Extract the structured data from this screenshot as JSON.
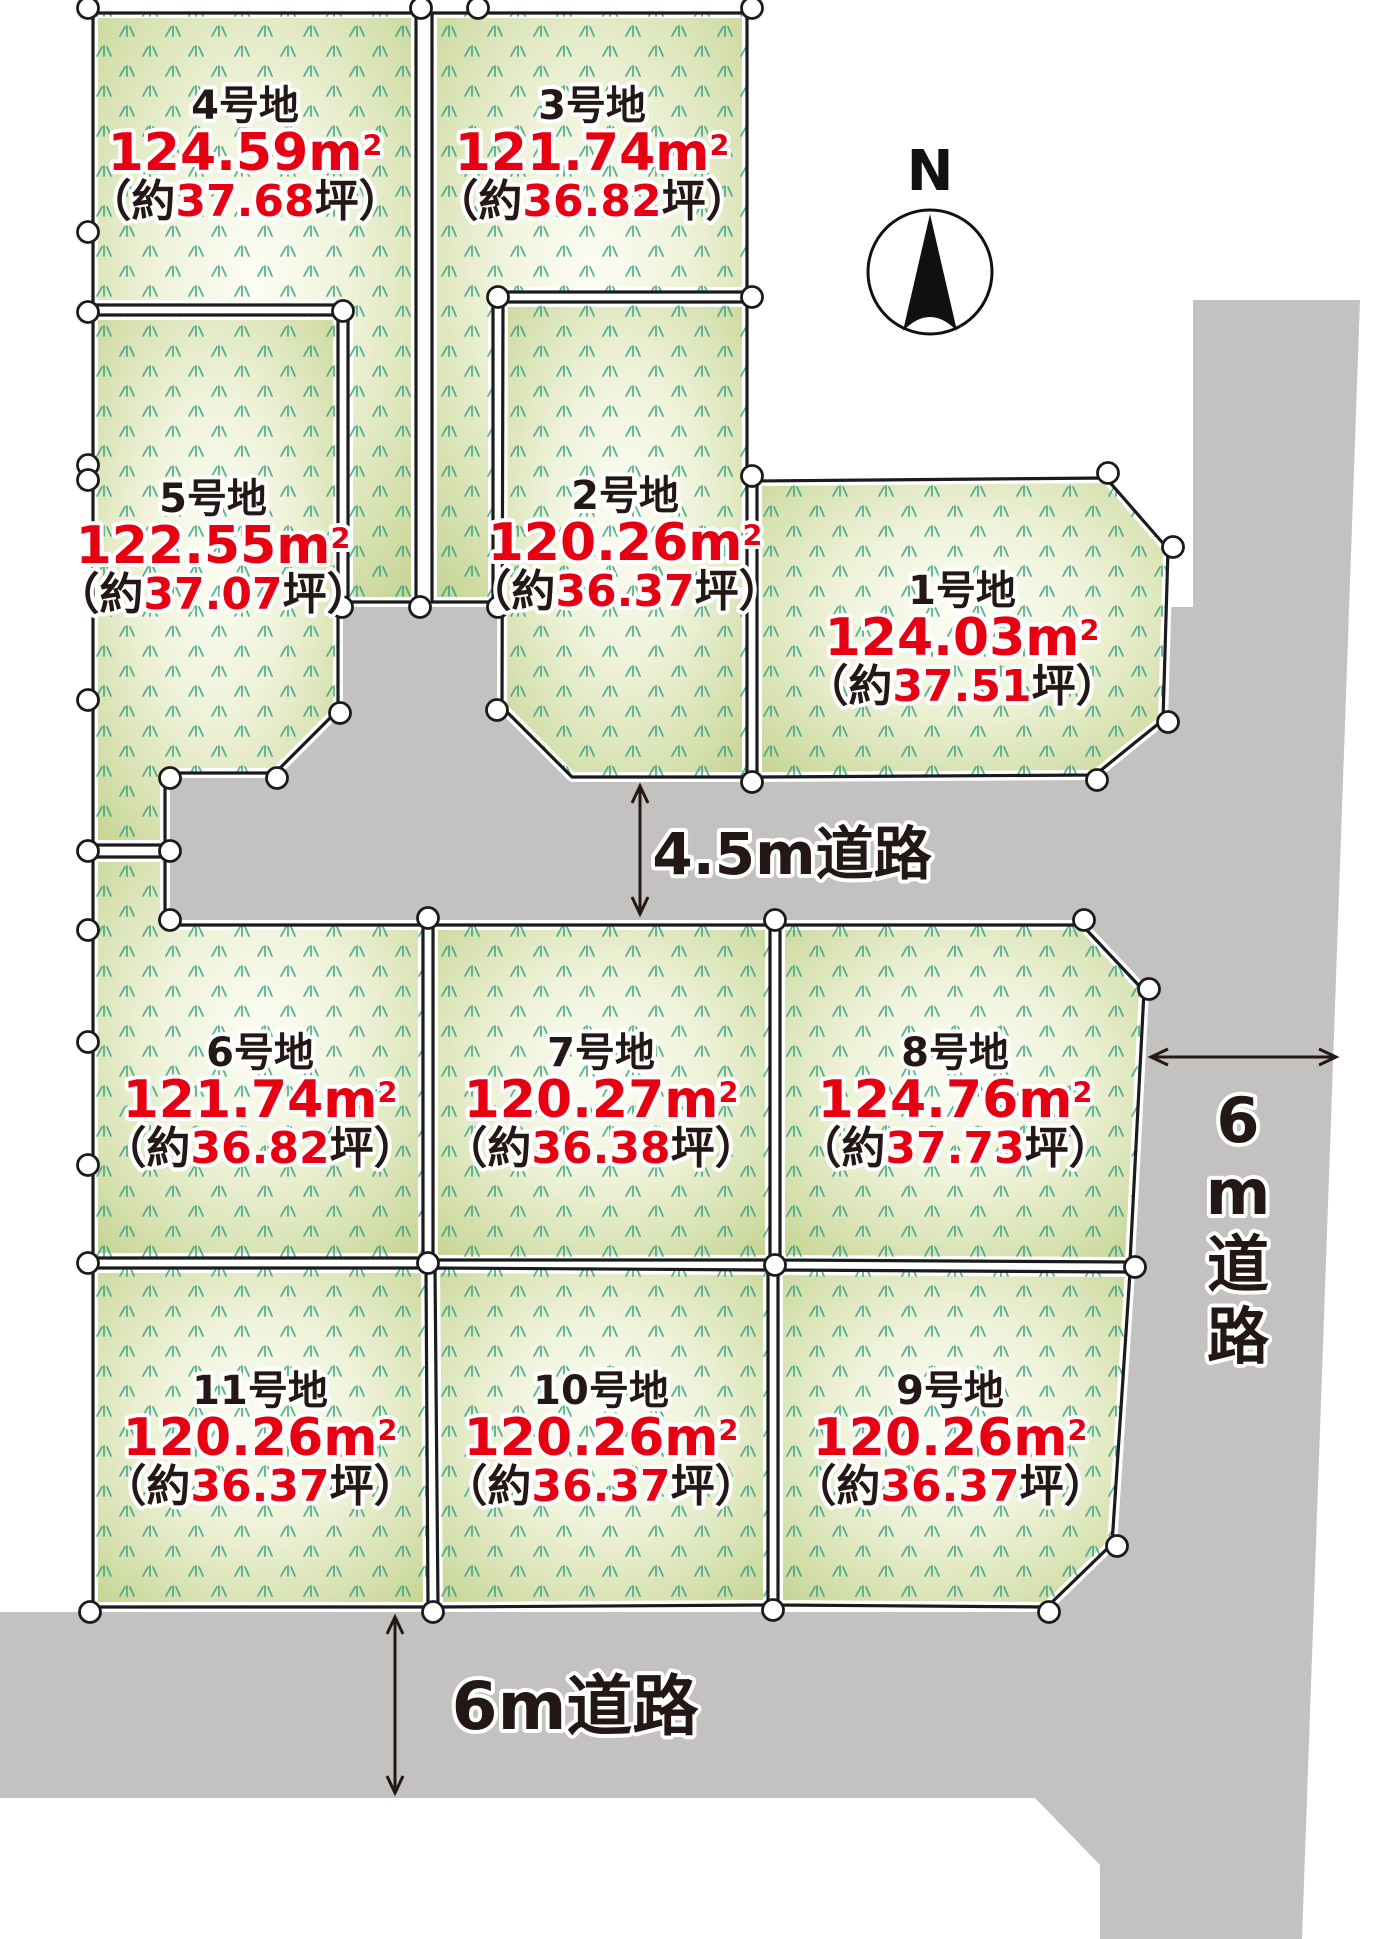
{
  "compass": {
    "label": "N"
  },
  "roads": {
    "middle": {
      "label": "4.5m道路"
    },
    "bottom": {
      "label": "6m道路"
    },
    "right": {
      "label": "6m道路"
    }
  },
  "units": {
    "area_unit_base": "m",
    "area_unit_sup": "2",
    "tsubo_prefix": "（約",
    "tsubo_suffix": "坪）"
  },
  "colors": {
    "road_gray": "#c3c2c1",
    "plot_edge_green": "#c2d38f",
    "plot_center_glow": "#fcfdf4",
    "grass_mark": "#2f9e82",
    "outline_black": "#1b1b1b",
    "text_black": "#231815",
    "text_red": "#e60012"
  },
  "plots": [
    {
      "no": 1,
      "name": "1号地",
      "area_m2": "124.03",
      "tsubo": "37.51",
      "points": [
        [
          757,
          481
        ],
        [
          1106,
          478
        ],
        [
          1168,
          549
        ],
        [
          1163,
          720
        ],
        [
          1095,
          775
        ],
        [
          757,
          777
        ]
      ],
      "label": {
        "x": 962,
        "y": 590
      }
    },
    {
      "no": 2,
      "name": "2号地",
      "area_m2": "120.26",
      "tsubo": "36.37",
      "points": [
        [
          503,
          302
        ],
        [
          747,
          302
        ],
        [
          747,
          777
        ],
        [
          572,
          777
        ],
        [
          502,
          707
        ]
      ],
      "label": {
        "x": 625,
        "y": 495
      }
    },
    {
      "no": 3,
      "name": "3号地",
      "area_m2": "121.74",
      "tsubo": "36.82",
      "points": [
        [
          432,
          13
        ],
        [
          747,
          13
        ],
        [
          747,
          292
        ],
        [
          493,
          292
        ],
        [
          493,
          602
        ],
        [
          432,
          602
        ]
      ],
      "label": {
        "x": 592,
        "y": 105
      }
    },
    {
      "no": 4,
      "name": "4号地",
      "area_m2": "124.59",
      "tsubo": "37.68",
      "points": [
        [
          93,
          13
        ],
        [
          416,
          13
        ],
        [
          416,
          602
        ],
        [
          348,
          602
        ],
        [
          348,
          305
        ],
        [
          93,
          305
        ]
      ],
      "label": {
        "x": 245,
        "y": 105
      }
    },
    {
      "no": 5,
      "name": "5号地",
      "area_m2": "122.55",
      "tsubo": "37.07",
      "points": [
        [
          93,
          315
        ],
        [
          338,
          315
        ],
        [
          338,
          710
        ],
        [
          275,
          773
        ],
        [
          165,
          773
        ],
        [
          165,
          845
        ],
        [
          93,
          845
        ]
      ],
      "label": {
        "x": 213,
        "y": 498
      }
    },
    {
      "no": 6,
      "name": "6号地",
      "area_m2": "121.74",
      "tsubo": "36.82",
      "points": [
        [
          93,
          857
        ],
        [
          165,
          857
        ],
        [
          165,
          925
        ],
        [
          423,
          925
        ],
        [
          423,
          1258
        ],
        [
          93,
          1258
        ]
      ],
      "label": {
        "x": 260,
        "y": 1052
      }
    },
    {
      "no": 7,
      "name": "7号地",
      "area_m2": "120.27",
      "tsubo": "36.38",
      "points": [
        [
          433,
          925
        ],
        [
          770,
          925
        ],
        [
          770,
          1260
        ],
        [
          433,
          1260
        ]
      ],
      "label": {
        "x": 601,
        "y": 1052
      }
    },
    {
      "no": 8,
      "name": "8号地",
      "area_m2": "124.76",
      "tsubo": "37.73",
      "points": [
        [
          780,
          925
        ],
        [
          1082,
          925
        ],
        [
          1144,
          991
        ],
        [
          1130,
          1262
        ],
        [
          780,
          1260
        ]
      ],
      "label": {
        "x": 955,
        "y": 1052
      }
    },
    {
      "no": 9,
      "name": "9号地",
      "area_m2": "120.26",
      "tsubo": "36.37",
      "points": [
        [
          778,
          1270
        ],
        [
          1130,
          1272
        ],
        [
          1112,
          1544
        ],
        [
          1047,
          1607
        ],
        [
          778,
          1605
        ]
      ],
      "label": {
        "x": 950,
        "y": 1390
      }
    },
    {
      "no": 10,
      "name": "10号地",
      "area_m2": "120.26",
      "tsubo": "36.37",
      "points": [
        [
          435,
          1268
        ],
        [
          768,
          1270
        ],
        [
          768,
          1605
        ],
        [
          438,
          1607
        ]
      ],
      "label": {
        "x": 601,
        "y": 1390
      }
    },
    {
      "no": 11,
      "name": "11号地",
      "area_m2": "120.26",
      "tsubo": "36.37",
      "points": [
        [
          93,
          1268
        ],
        [
          426,
          1268
        ],
        [
          428,
          1607
        ],
        [
          93,
          1607
        ]
      ],
      "label": {
        "x": 260,
        "y": 1390
      }
    }
  ],
  "road_polygons": [
    [
      [
        170,
        607
      ],
      [
        1330,
        607
      ],
      [
        1330,
        920
      ],
      [
        170,
        920
      ]
    ],
    [
      [
        1193,
        300
      ],
      [
        1360,
        300
      ],
      [
        1302,
        1939
      ],
      [
        1100,
        1939
      ],
      [
        1100,
        1865
      ],
      [
        1035,
        1798
      ],
      [
        1100,
        1798
      ],
      [
        1100,
        1612
      ],
      [
        1049,
        1612
      ],
      [
        1117,
        1546
      ],
      [
        1135,
        1270
      ],
      [
        1135,
        780
      ],
      [
        1193,
        780
      ]
    ],
    [
      [
        0,
        1612
      ],
      [
        1100,
        1612
      ],
      [
        1100,
        1798
      ],
      [
        0,
        1798
      ]
    ],
    [
      [
        1080,
        918
      ],
      [
        1155,
        994
      ],
      [
        1155,
        918
      ]
    ]
  ],
  "survey_points": [
    [
      88,
      8
    ],
    [
      421,
      8
    ],
    [
      478,
      8
    ],
    [
      752,
      8
    ],
    [
      88,
      232
    ],
    [
      88,
      312
    ],
    [
      343,
      311
    ],
    [
      88,
      465
    ],
    [
      88,
      480
    ],
    [
      88,
      700
    ],
    [
      342,
      607
    ],
    [
      420,
      607
    ],
    [
      498,
      607
    ],
    [
      340,
      713
    ],
    [
      277,
      778
    ],
    [
      170,
      778
    ],
    [
      170,
      851
    ],
    [
      88,
      851
    ],
    [
      498,
      297
    ],
    [
      752,
      297
    ],
    [
      497,
      710
    ],
    [
      752,
      782
    ],
    [
      752,
      476
    ],
    [
      1108,
      473
    ],
    [
      1173,
      547
    ],
    [
      1168,
      722
    ],
    [
      1097,
      780
    ],
    [
      170,
      920
    ],
    [
      428,
      918
    ],
    [
      88,
      930
    ],
    [
      88,
      1042
    ],
    [
      88,
      1165
    ],
    [
      775,
      920
    ],
    [
      1084,
      920
    ],
    [
      1149,
      989
    ],
    [
      1135,
      1267
    ],
    [
      88,
      1263
    ],
    [
      428,
      1263
    ],
    [
      775,
      1265
    ],
    [
      90,
      1612
    ],
    [
      433,
      1612
    ],
    [
      773,
      1610
    ],
    [
      1049,
      1612
    ],
    [
      1117,
      1546
    ]
  ],
  "dimension_lines": [
    {
      "x1": 640,
      "y1": 786,
      "x2": 640,
      "y2": 914
    },
    {
      "x1": 395,
      "y1": 1617,
      "x2": 395,
      "y2": 1793
    },
    {
      "x1": 1151,
      "y1": 1057,
      "x2": 1336,
      "y2": 1057
    }
  ]
}
